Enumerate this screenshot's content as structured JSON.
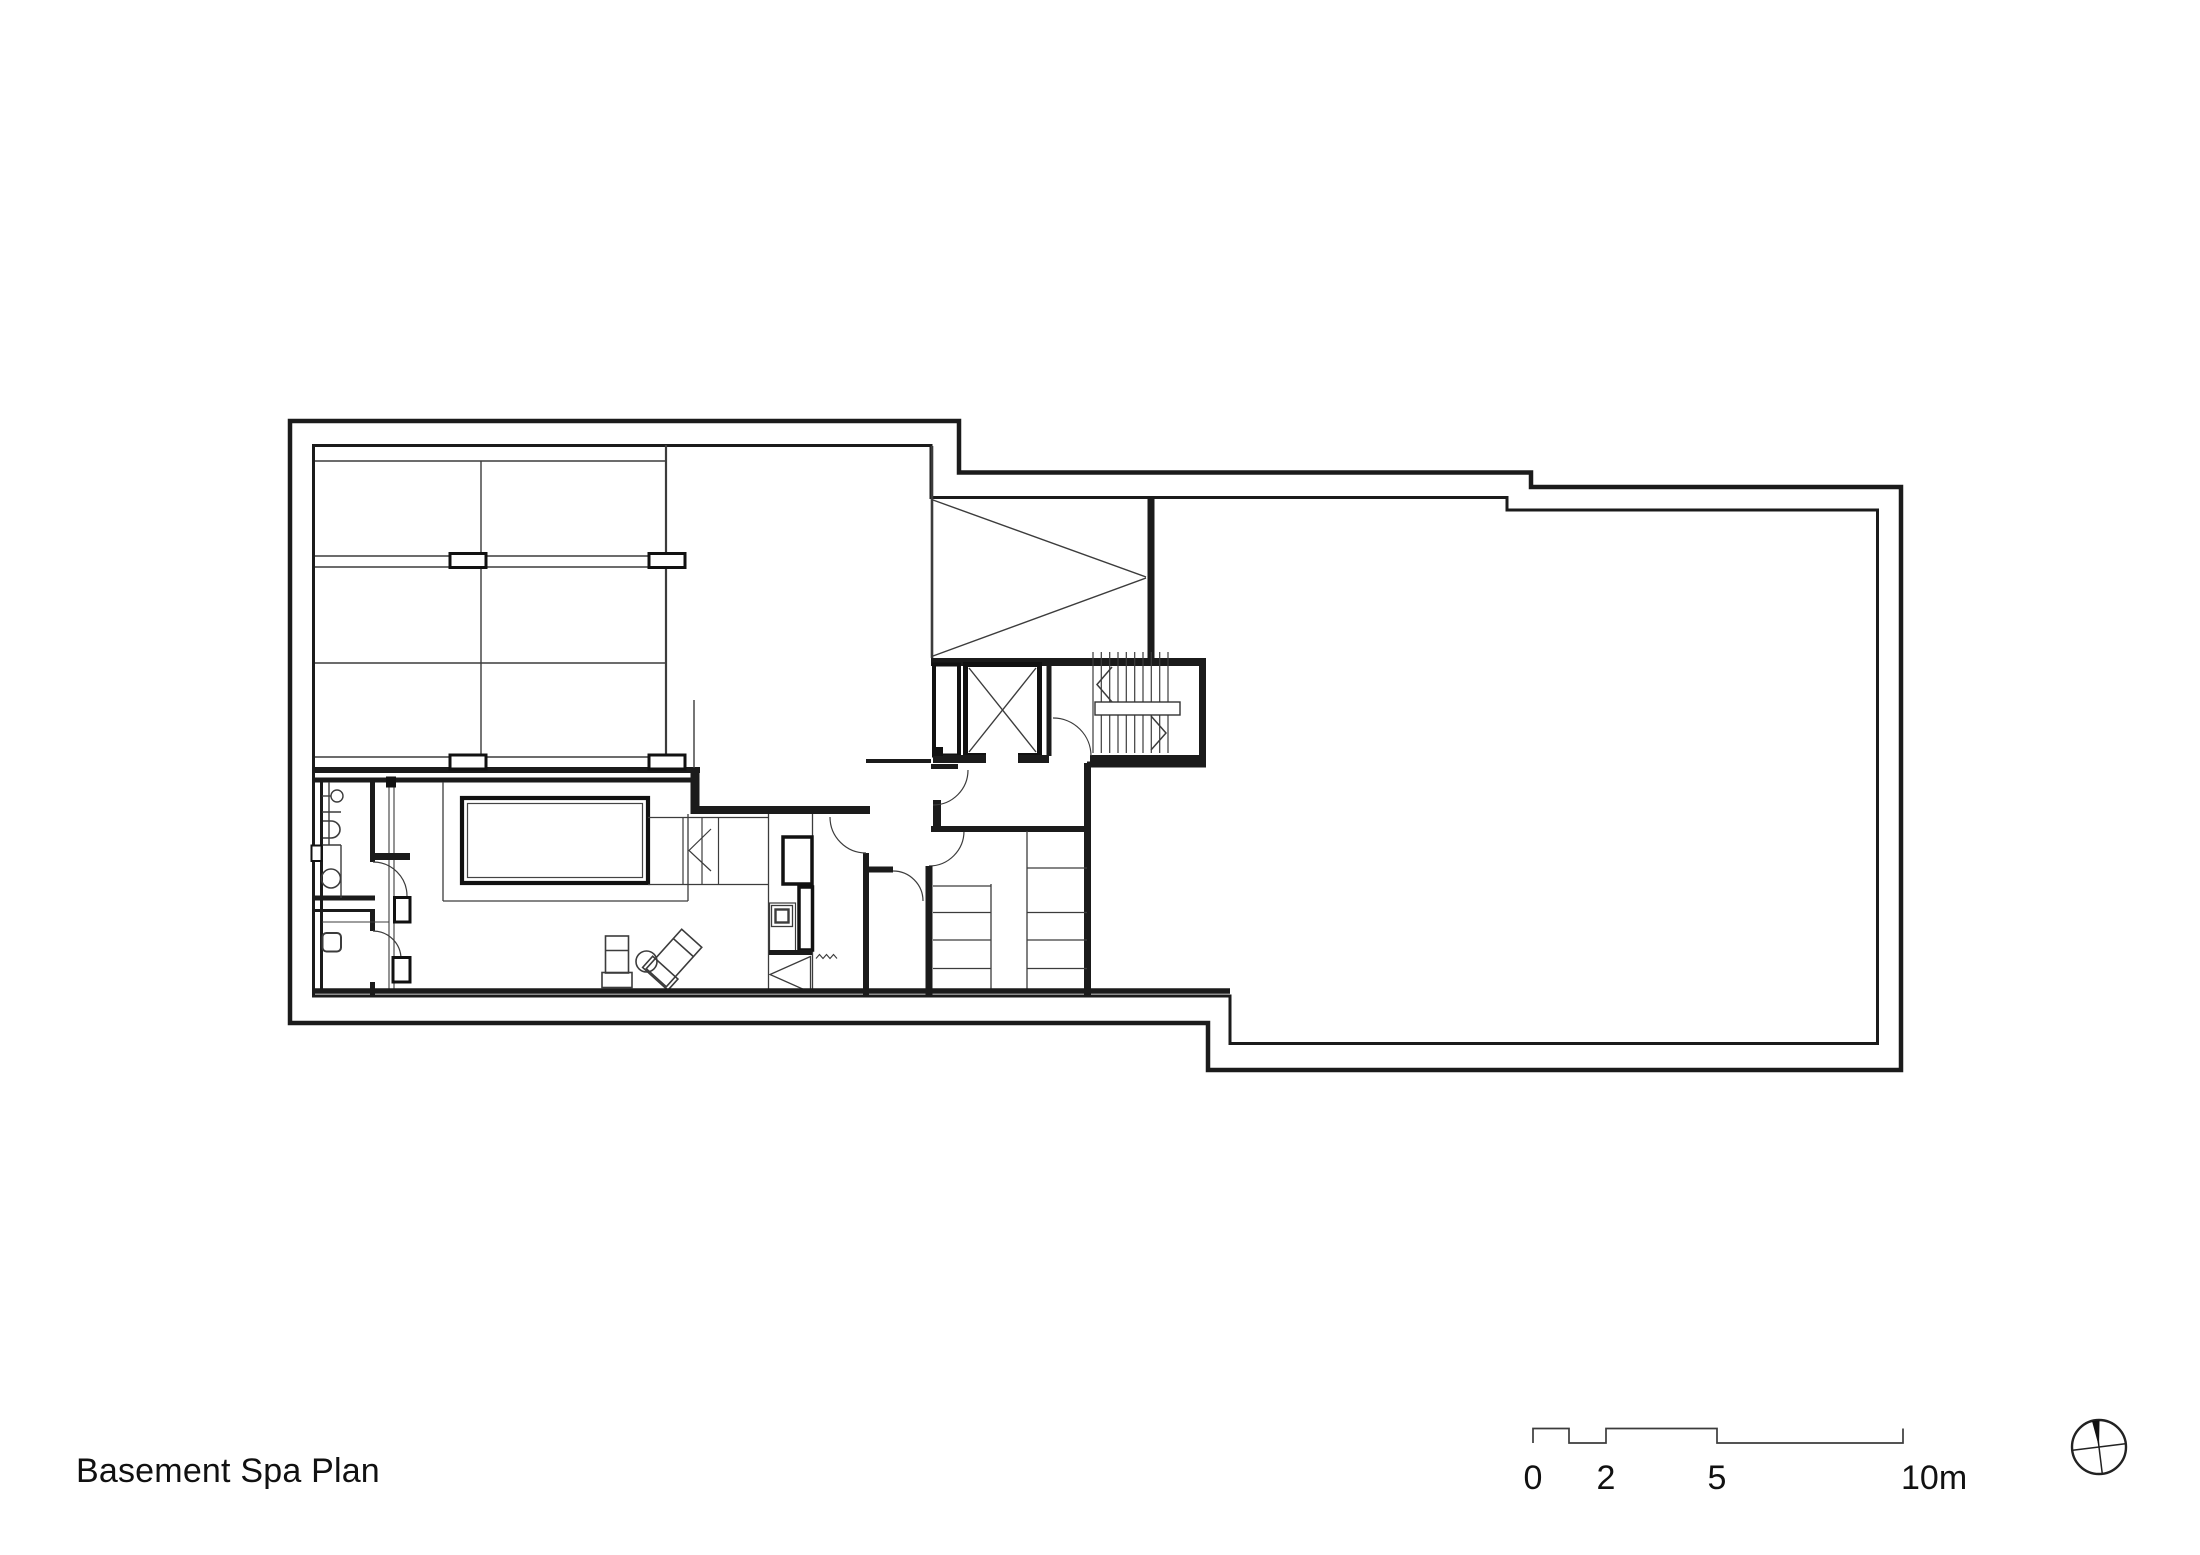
{
  "page": {
    "background": "#ffffff",
    "line_color": "#1b1b1b"
  },
  "drawing": {
    "title": "Basement Spa Plan"
  },
  "scale_bar": {
    "labels": {
      "zero": "0",
      "two": "2",
      "five": "5",
      "ten": "10m"
    }
  },
  "north_arrow": {
    "icon": "compass-north-icon"
  }
}
